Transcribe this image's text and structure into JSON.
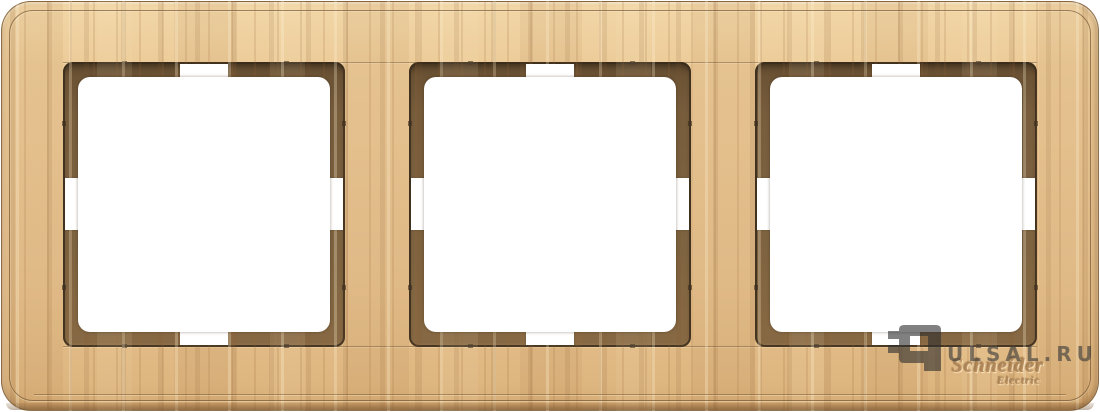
{
  "photo": {
    "subject": "triple wooden frame for switches and sockets, light wood finish",
    "apertures": {
      "count": 3,
      "labels": [
        "aperture-1",
        "aperture-2",
        "aperture-3"
      ]
    }
  },
  "brand": {
    "line1": "Schneider",
    "line2": "Electric"
  },
  "watermark": {
    "site_text": "ULSAL.RU",
    "logo": "pulsal-plug-logo-icon"
  },
  "colors": {
    "wood_light": "#f2d7a8",
    "wood_mid": "#e8c593",
    "wood_stripe": "#c99f6c",
    "recess_brown": "#7c6240",
    "recess_shadow": "#5a452c",
    "outline_dark": "#3d3020",
    "cutout_white": "#ffffff",
    "watermark_gray": "#3a3a3a"
  }
}
